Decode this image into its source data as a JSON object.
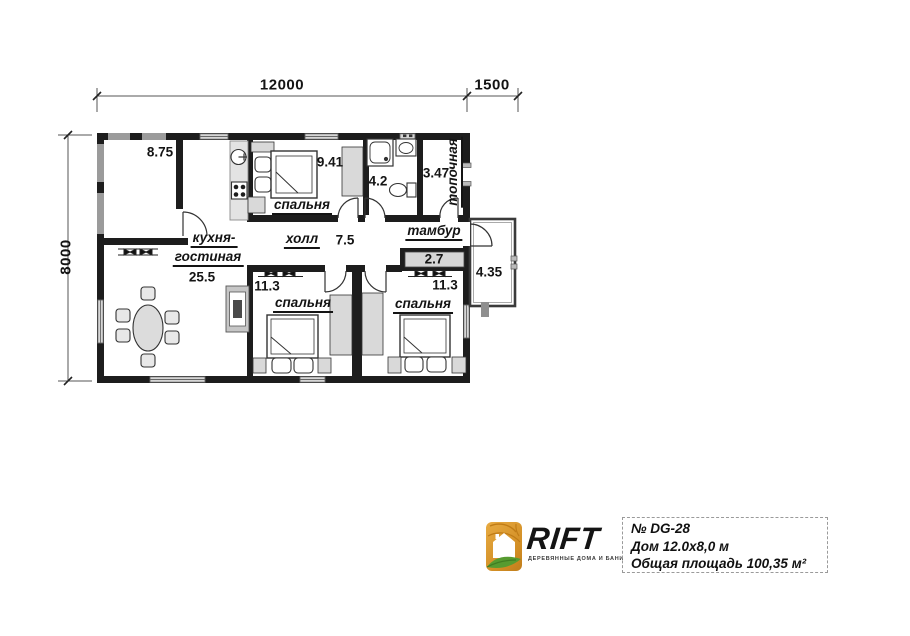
{
  "plan": {
    "dimensions": {
      "width_main": "12000",
      "width_porch": "1500",
      "height": "8000"
    },
    "rooms": {
      "terrace": {
        "area": "8.75"
      },
      "kitchen_living": {
        "name_line1": "кухня-",
        "name_line2": "гостиная",
        "area": "25.5"
      },
      "bedroom_top": {
        "name": "спальня",
        "area": "9.41"
      },
      "hall": {
        "name": "холл",
        "area": "7.5"
      },
      "bathroom": {
        "area": "4.2"
      },
      "boiler": {
        "name": "топочная",
        "area": "3.47"
      },
      "vestibule": {
        "name": "тамбур",
        "area": "2.7"
      },
      "porch": {
        "area": "4.35"
      },
      "bedroom_left": {
        "name": "спальня",
        "area": "11.3"
      },
      "bedroom_right": {
        "name": "спальня",
        "area": "11.3"
      }
    }
  },
  "logo": {
    "brand": "RIFT",
    "tagline": "ДЕРЕВЯННЫЕ ДОМА И БАНИ"
  },
  "title_block": {
    "project_number": "№ DG-28",
    "house_size": "Дом 12.0x8,0 м",
    "total_area": "Общая площадь 100,35 м²"
  },
  "colors": {
    "wall": "#1d1d1d",
    "terrace_wall": "#9b9b9b",
    "window_fill": "#d6d6d6",
    "furniture_gray": "#d9d9d9",
    "logo_orange": "#de9a31",
    "logo_green": "#569b30"
  }
}
